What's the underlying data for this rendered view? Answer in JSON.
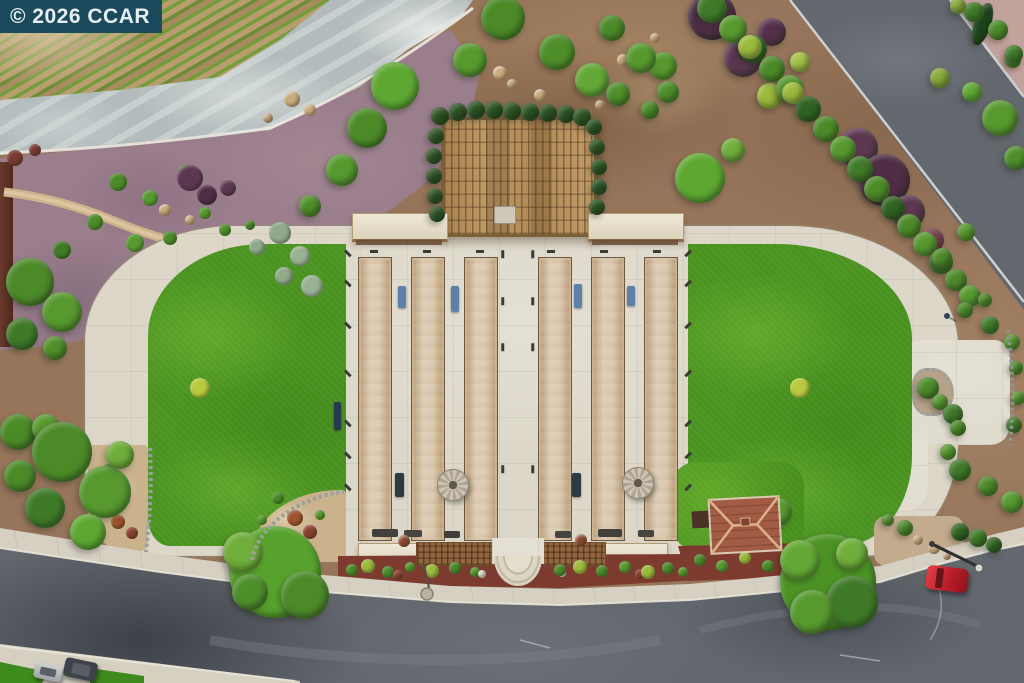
{
  "watermark": {
    "text": "© 2026 CCAR",
    "bg": "#1B4A5C",
    "fg": "#E7EEF1"
  },
  "scene": {
    "kind": "aerial-photo",
    "subject": "Overhead drone view of community bocce-ball courts flanked by lawns, a wooden pergola, vineyard rows, landscaped beds and surrounding streets",
    "palette": {
      "lawn": "#4a9320",
      "concrete": "#dcd7c8",
      "court_clay": "#d4bd9c",
      "asphalt": "#63676e",
      "dirt": "#96755b",
      "mulch_purple": "#9a7e8c",
      "mulch_red": "#7d3a2e",
      "pergola_wood": "#b28c5c",
      "watermark_bg": "#1B4A5C"
    },
    "counts": {
      "bocce_courts": 6,
      "umbrellas": 2,
      "cars_visible": 3
    },
    "courts": {
      "xs": [
        358,
        411,
        464,
        538,
        591,
        644
      ],
      "y": 257,
      "w": 32,
      "h": 282
    },
    "umbrellas": [
      [
        452,
        484,
        15
      ],
      [
        637,
        482,
        15
      ]
    ],
    "benches": [
      [
        398,
        286,
        8,
        22,
        "#5d80a8"
      ],
      [
        451,
        286,
        8,
        26,
        "#5d80a8"
      ],
      [
        574,
        284,
        8,
        24,
        "#5d80a8"
      ],
      [
        627,
        286,
        8,
        20,
        "#5d80a8"
      ],
      [
        395,
        473,
        9,
        24,
        "#2c3a44"
      ],
      [
        572,
        473,
        9,
        24,
        "#2c3a44"
      ],
      [
        334,
        402,
        7,
        28,
        "#27394e"
      ]
    ],
    "grills": [
      [
        372,
        529,
        26,
        8,
        "#403f3b"
      ],
      [
        404,
        530,
        18,
        7,
        "#45443f"
      ],
      [
        444,
        531,
        16,
        7,
        "#403f3b"
      ],
      [
        555,
        531,
        16,
        7,
        "#45443f"
      ],
      [
        598,
        529,
        24,
        8,
        "#403f3b"
      ],
      [
        638,
        530,
        16,
        7,
        "#45443f"
      ]
    ],
    "ticks": [
      [
        344,
        252,
        45
      ],
      [
        344,
        282,
        45
      ],
      [
        344,
        324,
        45
      ],
      [
        344,
        372,
        45
      ],
      [
        344,
        422,
        45
      ],
      [
        344,
        454,
        45
      ],
      [
        344,
        486,
        45
      ],
      [
        684,
        252,
        -45
      ],
      [
        684,
        282,
        -45
      ],
      [
        684,
        324,
        -45
      ],
      [
        684,
        372,
        -45
      ],
      [
        684,
        422,
        -45
      ],
      [
        684,
        454,
        -45
      ],
      [
        684,
        486,
        -45
      ],
      [
        499,
        253,
        90
      ],
      [
        529,
        253,
        90
      ],
      [
        499,
        300,
        90
      ],
      [
        529,
        300,
        90
      ],
      [
        499,
        346,
        90
      ],
      [
        529,
        346,
        90
      ],
      [
        499,
        468,
        90
      ],
      [
        529,
        468,
        90
      ],
      [
        370,
        250,
        0
      ],
      [
        423,
        250,
        0
      ],
      [
        476,
        250,
        0
      ],
      [
        547,
        250,
        0
      ],
      [
        600,
        250,
        0
      ],
      [
        653,
        250,
        0
      ]
    ],
    "trees": [
      [
        503,
        18,
        22,
        "#4c8a28"
      ],
      [
        470,
        60,
        17,
        "#579a2e"
      ],
      [
        395,
        86,
        24,
        "#5ea832"
      ],
      [
        367,
        128,
        20,
        "#4c8a28"
      ],
      [
        342,
        170,
        16,
        "#57992e"
      ],
      [
        310,
        206,
        11,
        "#4f8f2a"
      ],
      [
        557,
        52,
        18,
        "#4f8f2a"
      ],
      [
        592,
        80,
        17,
        "#63a836"
      ],
      [
        618,
        94,
        12,
        "#4f8f2a"
      ],
      [
        663,
        66,
        14,
        "#57992e"
      ],
      [
        650,
        110,
        9,
        "#4c8a28"
      ],
      [
        612,
        28,
        13,
        "#4c8a28"
      ],
      [
        641,
        58,
        15,
        "#57992e"
      ],
      [
        668,
        92,
        11,
        "#4f8f2a"
      ],
      [
        700,
        178,
        25,
        "#5ea832"
      ],
      [
        733,
        150,
        12,
        "#6fae3a"
      ],
      [
        712,
        16,
        24,
        "#4e2d45"
      ],
      [
        743,
        58,
        19,
        "#5c3751"
      ],
      [
        772,
        32,
        14,
        "#56304a"
      ],
      [
        770,
        96,
        13,
        "#9cba3c"
      ],
      [
        800,
        62,
        10,
        "#a6c246"
      ],
      [
        1000,
        118,
        18,
        "#57992e"
      ],
      [
        1016,
        158,
        12,
        "#4f8f2a"
      ],
      [
        972,
        92,
        10,
        "#5ea832"
      ],
      [
        940,
        78,
        10,
        "#87a83a"
      ],
      [
        1013,
        60,
        8,
        "#4f8f2a"
      ],
      [
        858,
        148,
        20,
        "#5c3751"
      ],
      [
        884,
        180,
        26,
        "#4e2d45"
      ],
      [
        908,
        212,
        17,
        "#5c3751"
      ],
      [
        932,
        240,
        12,
        "#7a4050"
      ],
      [
        982,
        24,
        22,
        "#1d451b",
        0.38,
        18
      ],
      [
        974,
        12,
        10,
        "#3f7a28"
      ],
      [
        998,
        30,
        10,
        "#4c8a28"
      ],
      [
        1014,
        54,
        9,
        "#3f7a28"
      ],
      [
        958,
        6,
        8,
        "#87a83a"
      ],
      [
        712,
        8,
        15,
        "#3f7a28"
      ],
      [
        733,
        29,
        14,
        "#57992e"
      ],
      [
        753,
        49,
        14,
        "#2f6322"
      ],
      [
        772,
        69,
        13,
        "#4c8a28"
      ],
      [
        790,
        89,
        14,
        "#57992e"
      ],
      [
        808,
        109,
        13,
        "#2f6322"
      ],
      [
        826,
        129,
        13,
        "#4c8a28"
      ],
      [
        843,
        149,
        13,
        "#57992e"
      ],
      [
        860,
        169,
        13,
        "#3f7a28"
      ],
      [
        877,
        189,
        13,
        "#4c8a28"
      ],
      [
        893,
        208,
        12,
        "#2f6322"
      ],
      [
        909,
        226,
        12,
        "#4c8a28"
      ],
      [
        925,
        244,
        12,
        "#57992e"
      ],
      [
        941,
        262,
        12,
        "#3f7a28"
      ],
      [
        956,
        280,
        11,
        "#4c8a28"
      ],
      [
        970,
        296,
        11,
        "#57992e"
      ],
      [
        750,
        47,
        12,
        "#9cba3c"
      ],
      [
        793,
        93,
        11,
        "#9cba3c"
      ],
      [
        30,
        282,
        24,
        "#4c8a28"
      ],
      [
        62,
        312,
        20,
        "#57992e"
      ],
      [
        22,
        334,
        16,
        "#3f7a28"
      ],
      [
        55,
        348,
        12,
        "#4f8f2a"
      ],
      [
        18,
        432,
        18,
        "#4c8a28"
      ],
      [
        46,
        428,
        14,
        "#57992e"
      ],
      [
        62,
        452,
        30,
        "#4c8a28"
      ],
      [
        105,
        492,
        26,
        "#57992e"
      ],
      [
        45,
        508,
        20,
        "#3f7a28"
      ],
      [
        88,
        532,
        18,
        "#5ea832"
      ],
      [
        20,
        476,
        16,
        "#4c8a28"
      ],
      [
        120,
        455,
        14,
        "#6fae3a"
      ],
      [
        275,
        572,
        46,
        "#57a22c"
      ],
      [
        243,
        552,
        20,
        "#6fae3a"
      ],
      [
        305,
        595,
        24,
        "#4c8a28"
      ],
      [
        250,
        592,
        18,
        "#4f8f2a"
      ],
      [
        828,
        582,
        48,
        "#4c9324"
      ],
      [
        800,
        560,
        20,
        "#63a836"
      ],
      [
        852,
        602,
        26,
        "#3f7a28"
      ],
      [
        812,
        612,
        22,
        "#57992e"
      ],
      [
        852,
        554,
        16,
        "#6fae3a"
      ],
      [
        778,
        512,
        14,
        "#57992e"
      ],
      [
        942,
        258,
        10,
        "#4c8a28"
      ],
      [
        966,
        232,
        9,
        "#57992e"
      ],
      [
        965,
        310,
        8,
        "#4c8a28"
      ],
      [
        990,
        325,
        9,
        "#3f7a28"
      ],
      [
        1012,
        342,
        8,
        "#57992e"
      ],
      [
        985,
        300,
        7,
        "#4c8a28"
      ],
      [
        1016,
        368,
        7,
        "#4c8a28"
      ],
      [
        1018,
        398,
        7,
        "#57992e"
      ],
      [
        1014,
        425,
        8,
        "#3f7a28"
      ],
      [
        948,
        452,
        8,
        "#57992e"
      ],
      [
        960,
        470,
        11,
        "#3f7a28"
      ],
      [
        988,
        486,
        10,
        "#4c8a28"
      ],
      [
        1012,
        502,
        11,
        "#57992e"
      ],
      [
        928,
        388,
        11,
        "#4c8a28"
      ],
      [
        940,
        402,
        8,
        "#57992e"
      ],
      [
        953,
        414,
        10,
        "#3f7a28"
      ],
      [
        958,
        428,
        8,
        "#4c8a28"
      ],
      [
        960,
        532,
        9,
        "#2f6322"
      ],
      [
        978,
        538,
        9,
        "#3f7a28"
      ],
      [
        994,
        545,
        8,
        "#2f6322"
      ],
      [
        905,
        528,
        8,
        "#4c8a28"
      ],
      [
        888,
        520,
        6,
        "#57992e"
      ],
      [
        440,
        116,
        9,
        "#2b5222"
      ],
      [
        458,
        112,
        9,
        "#2b5222"
      ],
      [
        476,
        110,
        9,
        "#2b5222"
      ],
      [
        494,
        110,
        9,
        "#2b5222"
      ],
      [
        512,
        111,
        9,
        "#2b5222"
      ],
      [
        530,
        112,
        9,
        "#2b5222"
      ],
      [
        548,
        113,
        9,
        "#2b5222"
      ],
      [
        566,
        114,
        9,
        "#2b5222"
      ],
      [
        582,
        117,
        9,
        "#2b5222"
      ],
      [
        594,
        127,
        8,
        "#2b5222"
      ],
      [
        597,
        147,
        8,
        "#2b5222"
      ],
      [
        599,
        167,
        8,
        "#2b5222"
      ],
      [
        599,
        187,
        8,
        "#2b5222"
      ],
      [
        597,
        207,
        8,
        "#2b5222"
      ],
      [
        436,
        136,
        8,
        "#2b5222"
      ],
      [
        434,
        156,
        8,
        "#2b5222"
      ],
      [
        434,
        176,
        8,
        "#2b5222"
      ],
      [
        435,
        196,
        8,
        "#2b5222"
      ],
      [
        437,
        214,
        8,
        "#2b5222"
      ]
    ],
    "shrubs": [
      [
        118,
        182,
        9,
        "#4c8a28"
      ],
      [
        150,
        198,
        8,
        "#57992e"
      ],
      [
        185,
        172,
        7,
        "#4f8f2a"
      ],
      [
        95,
        222,
        8,
        "#4c8a28"
      ],
      [
        135,
        243,
        9,
        "#57992e"
      ],
      [
        62,
        250,
        9,
        "#3f7a28"
      ],
      [
        170,
        238,
        7,
        "#4c8a28"
      ],
      [
        205,
        213,
        6,
        "#57992e"
      ],
      [
        225,
        230,
        6,
        "#4f8f2a"
      ],
      [
        250,
        225,
        5,
        "#4c8a28"
      ],
      [
        280,
        233,
        11,
        "#8fa98a"
      ],
      [
        300,
        256,
        10,
        "#9bb194"
      ],
      [
        284,
        276,
        9,
        "#8fa98a"
      ],
      [
        312,
        286,
        11,
        "#9bb194"
      ],
      [
        257,
        247,
        8,
        "#8fa98a"
      ],
      [
        190,
        178,
        13,
        "#5c3751"
      ],
      [
        207,
        195,
        10,
        "#4e2d45"
      ],
      [
        228,
        188,
        8,
        "#5c3751"
      ],
      [
        15,
        158,
        8,
        "#7a3b30"
      ],
      [
        35,
        150,
        6,
        "#7a3b30"
      ],
      [
        200,
        388,
        10,
        "#b8c93e"
      ],
      [
        800,
        388,
        10,
        "#b8c93e"
      ],
      [
        108,
        470,
        6,
        "#4c8a28"
      ],
      [
        125,
        500,
        5,
        "#57992e"
      ],
      [
        118,
        522,
        7,
        "#a0522d"
      ],
      [
        132,
        533,
        6,
        "#8a4030"
      ],
      [
        100,
        508,
        4,
        "#4c8a28"
      ],
      [
        278,
        498,
        6,
        "#4c8a28"
      ],
      [
        262,
        520,
        5,
        "#57992e"
      ],
      [
        295,
        518,
        8,
        "#a0522d"
      ],
      [
        310,
        532,
        7,
        "#8a4030"
      ],
      [
        285,
        540,
        5,
        "#4c8a28"
      ],
      [
        320,
        515,
        5,
        "#57992e"
      ],
      [
        352,
        570,
        6,
        "#4c8a28"
      ],
      [
        368,
        566,
        7,
        "#9cba3c"
      ],
      [
        388,
        572,
        6,
        "#4c8a28"
      ],
      [
        398,
        575,
        5,
        "#8a4030"
      ],
      [
        410,
        567,
        5,
        "#57992e"
      ],
      [
        432,
        571,
        7,
        "#9cba3c"
      ],
      [
        455,
        568,
        6,
        "#4c8a28"
      ],
      [
        475,
        572,
        5,
        "#57992e"
      ],
      [
        482,
        574,
        4,
        "#dfe3d2"
      ],
      [
        562,
        573,
        4,
        "#dfe3d2"
      ],
      [
        560,
        570,
        6,
        "#4c8a28"
      ],
      [
        580,
        567,
        7,
        "#9cba3c"
      ],
      [
        602,
        571,
        6,
        "#4c8a28"
      ],
      [
        625,
        567,
        6,
        "#57992e"
      ],
      [
        640,
        574,
        5,
        "#8a4030"
      ],
      [
        648,
        572,
        7,
        "#9cba3c"
      ],
      [
        668,
        568,
        6,
        "#4c8a28"
      ],
      [
        683,
        572,
        5,
        "#57992e"
      ],
      [
        700,
        560,
        6,
        "#4c8a28"
      ],
      [
        722,
        566,
        6,
        "#57992e"
      ],
      [
        745,
        558,
        6,
        "#9cba3c"
      ],
      [
        768,
        566,
        6,
        "#4c8a28"
      ],
      [
        788,
        560,
        5,
        "#57992e"
      ]
    ],
    "rocks": [
      [
        165,
        210,
        6,
        "#c6a87c"
      ],
      [
        190,
        220,
        5,
        "#c6a87c"
      ],
      [
        292,
        99,
        8,
        "#c9ab7e"
      ],
      [
        310,
        110,
        6,
        "#c9ab7e"
      ],
      [
        268,
        118,
        5,
        "#c2a276"
      ],
      [
        500,
        73,
        7,
        "#cbad80"
      ],
      [
        512,
        84,
        5,
        "#c2a276"
      ],
      [
        540,
        95,
        6,
        "#c9ab7e"
      ],
      [
        600,
        105,
        5,
        "#c2a276"
      ],
      [
        623,
        60,
        6,
        "#c9ab7e"
      ],
      [
        655,
        38,
        5,
        "#c2a276"
      ],
      [
        918,
        540,
        5,
        "#c2a276"
      ],
      [
        934,
        548,
        6,
        "#c9ab7e"
      ],
      [
        947,
        556,
        4,
        "#c2a276"
      ],
      [
        112,
        488,
        4,
        "#b9a183"
      ],
      [
        404,
        541,
        6,
        "#8a4a2e"
      ],
      [
        581,
        540,
        6,
        "#8a4a2e"
      ]
    ]
  }
}
